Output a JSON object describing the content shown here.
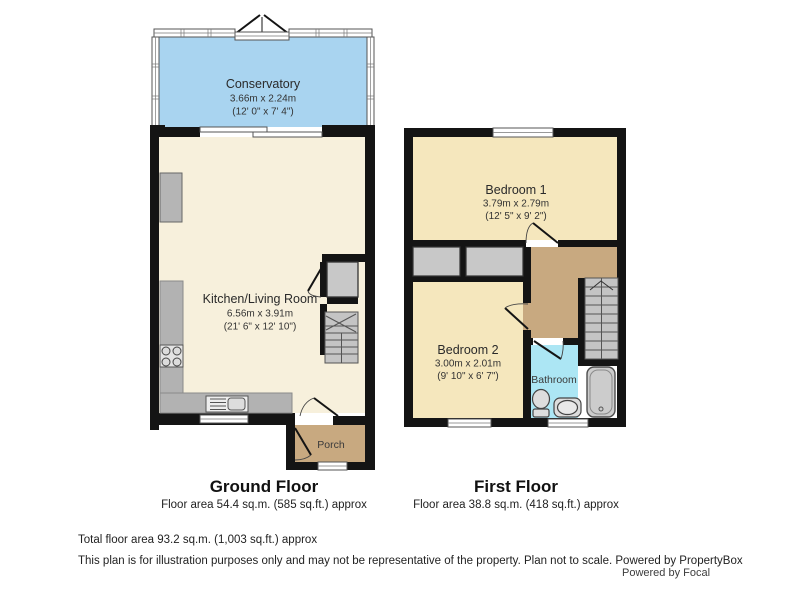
{
  "colors": {
    "wall": "#141414",
    "conservatory": "#a9d4f0",
    "kitchen_living": "#f7f0dc",
    "bedroom": "#f5e7bd",
    "landing_porch": "#c8a980",
    "bathroom": "#ace6f4",
    "fixture_gray": "#c8c8c8",
    "counter_gray": "#b2b2b2",
    "stairs_gray": "#c4c4c4"
  },
  "ground_floor": {
    "title": "Ground Floor",
    "area_text": "Floor area 54.4 sq.m. (585 sq.ft.) approx",
    "rooms": {
      "conservatory": {
        "name": "Conservatory",
        "dims_m": "3.66m x 2.24m",
        "dims_ft": "(12' 0\" x 7' 4\")"
      },
      "kitchen_living": {
        "name": "Kitchen/Living Room",
        "dims_m": "6.56m x 3.91m",
        "dims_ft": "(21' 6\" x 12' 10\")"
      },
      "porch": {
        "name": "Porch"
      }
    }
  },
  "first_floor": {
    "title": "First Floor",
    "area_text": "Floor area 38.8 sq.m. (418 sq.ft.) approx",
    "rooms": {
      "bedroom1": {
        "name": "Bedroom 1",
        "dims_m": "3.79m x 2.79m",
        "dims_ft": "(12' 5\" x 9' 2\")"
      },
      "bedroom2": {
        "name": "Bedroom 2",
        "dims_m": "3.00m x 2.01m",
        "dims_ft": "(9' 10\" x 6' 7\")"
      },
      "bathroom": {
        "name": "Bathroom"
      }
    }
  },
  "footer": {
    "total_area": "Total floor area 93.2 sq.m. (1,003 sq.ft.) approx",
    "disclaimer": "This plan is for illustration purposes only and may not be representative of the property. Plan not to scale. Powered by PropertyBox",
    "powered_by": "Powered by Focal"
  }
}
